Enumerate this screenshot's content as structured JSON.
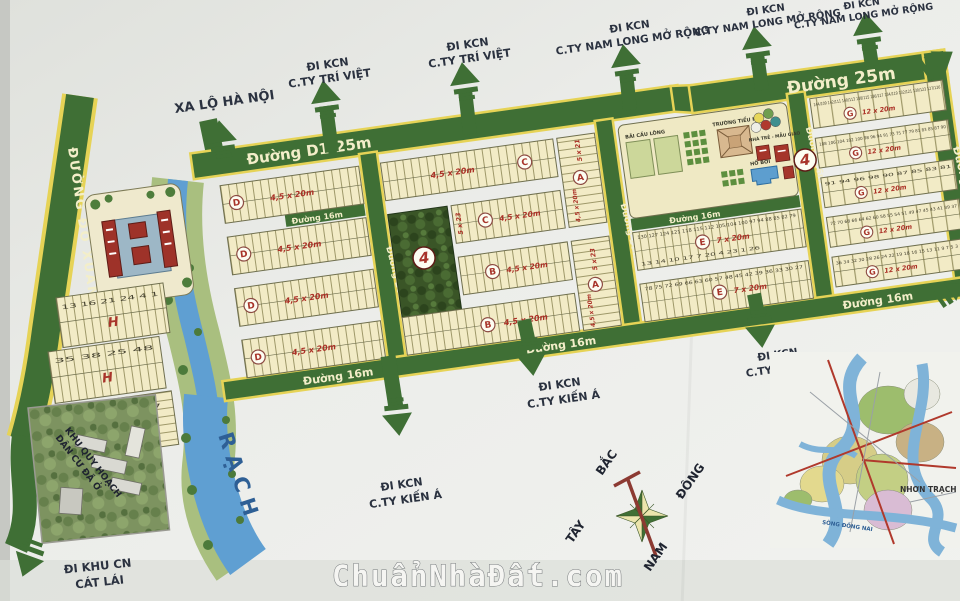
{
  "watermark": "ChuẩnNhàĐất.com",
  "colors": {
    "road_green": "#3f6f35",
    "edge_yellow": "#e6d356",
    "block_cream": "#f2ebc6",
    "water_blue": "#5f9fd2",
    "accent_red": "#ab3026",
    "paper": "#e9eae6"
  },
  "roads": {
    "do_xuan_hop": "ĐƯỜNG ĐỖ XUÂN HỢP",
    "d1": "Đường D1-25m",
    "r25": "Đường 25m",
    "r20": "Đường 20m",
    "r16": "Đường 16m",
    "rach": "RẠCH"
  },
  "exits": [
    {
      "l1": "XA LỘ HÀ NỘI",
      "l2": ""
    },
    {
      "l1": "ĐI KCN",
      "l2": "C.TY TRÍ VIỆT"
    },
    {
      "l1": "ĐI KCN",
      "l2": "C.TY TRÍ VIỆT"
    },
    {
      "l1": "ĐI KCN",
      "l2": "C.TY NAM LONG MỞ RỘNG"
    },
    {
      "l1": "ĐI KCN",
      "l2": "C.TY NAM LONG MỞ RỘNG"
    },
    {
      "l1": "ĐI KCN",
      "l2": "C.TY NAM LONG MỞ RỘNG"
    },
    {
      "l1": "ĐI KCN",
      "l2": "C.TY KIẾN Á"
    },
    {
      "l1": "ĐI KCN",
      "l2": "C.TY KIẾN Á"
    },
    {
      "l1": "ĐI KCN",
      "l2": "C.TY KIẾN Á"
    },
    {
      "l1": "ĐI KHU CN",
      "l2": "CÁT LÁI"
    }
  ],
  "blocks": {
    "d": {
      "letter": "D",
      "size": "4,5 x 20m"
    },
    "c": {
      "letter": "C",
      "size": "4,5 x 20m",
      "size2": "5 x 23"
    },
    "b": {
      "letter": "B",
      "size": "4,5 x 20m"
    },
    "a": {
      "letter": "A",
      "size": "4,5 x 20m",
      "size2": "5 x 23",
      "size3": "5 x 21"
    },
    "e": {
      "letter": "E",
      "size": "7 x 20m"
    },
    "g": {
      "letter": "G",
      "size": "12 x 20m"
    },
    "h": {
      "letter": "H"
    },
    "highlight": "4"
  },
  "lots": {
    "g0": [
      "144/109",
      "142/111",
      "140/113",
      "138/115",
      "136/117",
      "134/119",
      "132/121",
      "130/123",
      "127/126"
    ],
    "g1": [
      "108",
      "106",
      "104",
      "102",
      "100",
      "98",
      "96",
      "94",
      "91",
      "73",
      "75",
      "77",
      "79",
      "81",
      "83",
      "85",
      "87",
      "90"
    ],
    "g2": [
      "91",
      "94",
      "96",
      "98",
      "90",
      "87",
      "85",
      "83",
      "81"
    ],
    "g3": [
      "72",
      "70",
      "68",
      "66",
      "64",
      "62",
      "60",
      "58",
      "55",
      "54",
      "51",
      "49",
      "47",
      "45",
      "43",
      "41",
      "39",
      "37"
    ],
    "g4": [
      "36",
      "34",
      "32",
      "30",
      "28",
      "26",
      "24",
      "22",
      "19",
      "18",
      "16",
      "15",
      "13",
      "11",
      "9",
      "7",
      "5",
      "3",
      "1"
    ],
    "e1": [
      "130",
      "127",
      "124",
      "121",
      "118",
      "115",
      "112",
      "105/104",
      "100",
      "97",
      "94",
      "88",
      "85",
      "82",
      "79"
    ],
    "e2": [
      "78",
      "75",
      "72",
      "69",
      "66",
      "63",
      "60",
      "57",
      "48",
      "45",
      "42",
      "39",
      "36",
      "33",
      "30",
      "27"
    ],
    "e_small": [
      "13",
      "14",
      "10",
      "17",
      "7",
      "20",
      "4",
      "23",
      "1",
      "26"
    ],
    "h1": [
      "13",
      "16",
      "21",
      "24",
      "4",
      "1"
    ],
    "h2": [
      "35",
      "38",
      "25",
      "48"
    ],
    "h3": [
      "54",
      "57"
    ]
  },
  "amenities": {
    "badminton": "BÃI CẦU LÔNG",
    "school": "TRƯỜNG TIỂU HỌC",
    "pool": "HỒ BƠI",
    "kindergarten": "NHÀ TRẺ - MẪU GIÁO"
  },
  "inset": {
    "l1": "KHU QUY HOẠCH",
    "l2": "DÂN CƯ ĐÃ Ở"
  },
  "compass": {
    "n": "BẮC",
    "s": "NAM",
    "e": "ĐÔNG",
    "w": "TÂY"
  },
  "minimap": {
    "river": "SÔNG ĐỒNG NAI",
    "area": "NHƠN TRẠCH"
  }
}
